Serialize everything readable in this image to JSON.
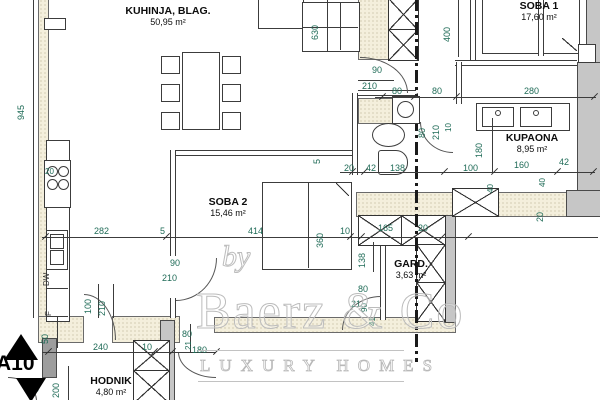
{
  "plan": {
    "clipped_top_line": "DNEVNI BORAVAK,",
    "section_marker": "A10",
    "appliance_labels": {
      "dishwasher": "DW",
      "fridge": "F"
    }
  },
  "rooms": [
    {
      "name": "KUHINJA, BLAG.",
      "area": "50,95 m²",
      "x": 98,
      "y": 5,
      "w": 140
    },
    {
      "name": "SOBA 1",
      "area": "17,60 m²",
      "x": 489,
      "y": 0,
      "w": 100
    },
    {
      "name": "SOBA 2",
      "area": "15,46 m²",
      "x": 178,
      "y": 196,
      "w": 100
    },
    {
      "name": "KUPAONA",
      "area": "8,95 m²",
      "x": 482,
      "y": 132,
      "w": 100
    },
    {
      "name": "GARD.",
      "area": "3,63 m²",
      "x": 381,
      "y": 258,
      "w": 60
    },
    {
      "name": "HODNIK",
      "area": "4,80 m²",
      "x": 71,
      "y": 375,
      "w": 80
    }
  ],
  "dimensions": [
    {
      "t": "945",
      "x": 26,
      "y": 111,
      "r": 1
    },
    {
      "t": "630",
      "x": 320,
      "y": 31,
      "r": 1
    },
    {
      "t": "400",
      "x": 452,
      "y": 33,
      "r": 1
    },
    {
      "t": "90",
      "x": 372,
      "y": 66
    },
    {
      "t": "210",
      "x": 362,
      "y": 82
    },
    {
      "t": "80",
      "x": 392,
      "y": 87
    },
    {
      "t": "80",
      "x": 432,
      "y": 87
    },
    {
      "t": "280",
      "x": 524,
      "y": 87
    },
    {
      "t": "5",
      "x": 322,
      "y": 155,
      "r": 1
    },
    {
      "t": "20",
      "x": 344,
      "y": 164
    },
    {
      "t": "42",
      "x": 366,
      "y": 164
    },
    {
      "t": "138",
      "x": 390,
      "y": 164
    },
    {
      "t": "100",
      "x": 463,
      "y": 164
    },
    {
      "t": "160",
      "x": 514,
      "y": 161
    },
    {
      "t": "42",
      "x": 559,
      "y": 158
    },
    {
      "t": "180",
      "x": 484,
      "y": 149,
      "r": 1
    },
    {
      "t": "80",
      "x": 427,
      "y": 129,
      "r": 1
    },
    {
      "t": "210",
      "x": 441,
      "y": 131,
      "r": 1
    },
    {
      "t": "10",
      "x": 453,
      "y": 124,
      "r": 1,
      "fs": 8
    },
    {
      "t": "40",
      "x": 495,
      "y": 185,
      "r": 1,
      "fs": 8
    },
    {
      "t": "40",
      "x": 547,
      "y": 179,
      "r": 1,
      "fs": 8
    },
    {
      "t": "20",
      "x": 545,
      "y": 213,
      "r": 1
    },
    {
      "t": "282",
      "x": 94,
      "y": 227
    },
    {
      "t": "5",
      "x": 160,
      "y": 227
    },
    {
      "t": "414",
      "x": 248,
      "y": 227
    },
    {
      "t": "360",
      "x": 325,
      "y": 239,
      "r": 1
    },
    {
      "t": "10",
      "x": 340,
      "y": 227
    },
    {
      "t": "165",
      "x": 378,
      "y": 224
    },
    {
      "t": "20",
      "x": 418,
      "y": 224
    },
    {
      "t": "90",
      "x": 170,
      "y": 259
    },
    {
      "t": "210",
      "x": 162,
      "y": 274
    },
    {
      "t": "138",
      "x": 367,
      "y": 259,
      "r": 1
    },
    {
      "t": "80",
      "x": 358,
      "y": 285
    },
    {
      "t": "21",
      "x": 351,
      "y": 300
    },
    {
      "t": "90",
      "x": 369,
      "y": 304,
      "r": 1,
      "fs": 8
    },
    {
      "t": "41",
      "x": 377,
      "y": 318,
      "r": 1,
      "fs": 8
    },
    {
      "t": "100",
      "x": 93,
      "y": 305,
      "r": 1
    },
    {
      "t": "210",
      "x": 107,
      "y": 307,
      "r": 1
    },
    {
      "t": "50",
      "x": 50,
      "y": 335,
      "r": 1
    },
    {
      "t": "80",
      "x": 182,
      "y": 330
    },
    {
      "t": "21",
      "x": 193,
      "y": 342,
      "r": 1,
      "fs": 8
    },
    {
      "t": "240",
      "x": 93,
      "y": 343
    },
    {
      "t": "10",
      "x": 142,
      "y": 343
    },
    {
      "t": "180",
      "x": 192,
      "y": 346
    },
    {
      "t": "200",
      "x": 61,
      "y": 389,
      "r": 1
    },
    {
      "t": "100",
      "x": 24,
      "y": 385
    },
    {
      "t": "20",
      "x": 45,
      "y": 168,
      "fs": 8
    }
  ],
  "watermark": {
    "by": "by",
    "brand": "Baerz & Co",
    "tagline": "LUXURY HOMES"
  },
  "colors": {
    "dimension_text": "#1f6b57",
    "wall_fill": "#f4efdc",
    "gray_wall": "#c6c6c6",
    "watermark": "#bcbcbc"
  }
}
